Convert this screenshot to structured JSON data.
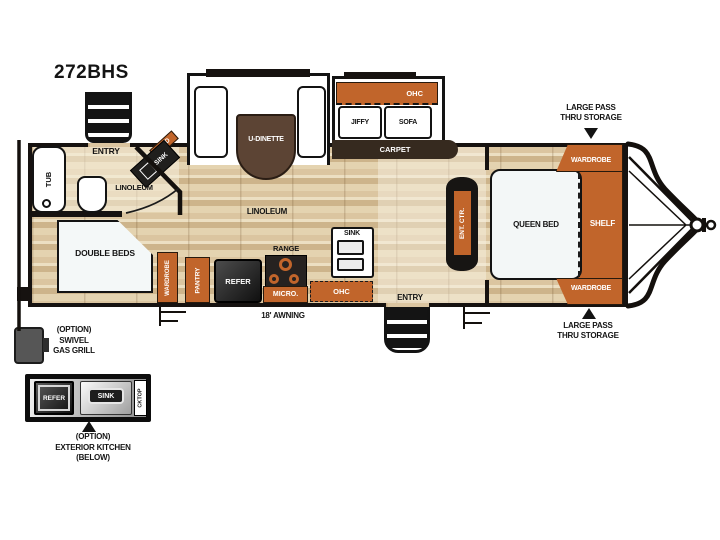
{
  "title": "272BHS",
  "colors": {
    "accent_orange": "#c1652b",
    "wall_dark": "#161210",
    "wood_tan": "#dbc5a0"
  },
  "bath": {
    "entry": "ENTRY",
    "tub": "TUB",
    "med": "MED",
    "corner_sink": "SINK",
    "linoleum": "LINOLEUM"
  },
  "dinette_slide": {
    "label": "U-DINETTE"
  },
  "sofa_slide": {
    "ohc": "OHC",
    "jiffy": "JIFFY",
    "sofa": "SOFA",
    "carpet": "CARPET"
  },
  "main": {
    "linoleum": "LINOLEUM",
    "double_beds": "DOUBLE BEDS",
    "awning": "18' AWNING",
    "entry": "ENTRY"
  },
  "kitchen": {
    "wardrobe": "WARDROBE",
    "pantry": "PANTRY",
    "refer": "REFER",
    "range": "RANGE",
    "micro": "MICRO.",
    "ohc": "OHC",
    "sink": "SINK"
  },
  "bedroom": {
    "ent_ctr": "ENT. CTR.",
    "queen_bed": "QUEEN BED",
    "shelf": "SHELF",
    "wardrobe_top": "WARDROBE",
    "wardrobe_bottom": "WARDROBE"
  },
  "callouts": {
    "storage_top_line1": "LARGE PASS",
    "storage_top_line2": "THRU STORAGE",
    "storage_bottom_line1": "LARGE PASS",
    "storage_bottom_line2": "THRU STORAGE",
    "grill_line1": "(OPTION)",
    "grill_line2": "SWIVEL",
    "grill_line3": "GAS GRILL",
    "ext_caption_line1": "(OPTION)",
    "ext_caption_line2": "EXTERIOR KITCHEN",
    "ext_caption_line3": "(BELOW)"
  },
  "exterior_kitchen": {
    "refer": "REFER",
    "sink": "SINK",
    "cktop": "CKTOP"
  }
}
